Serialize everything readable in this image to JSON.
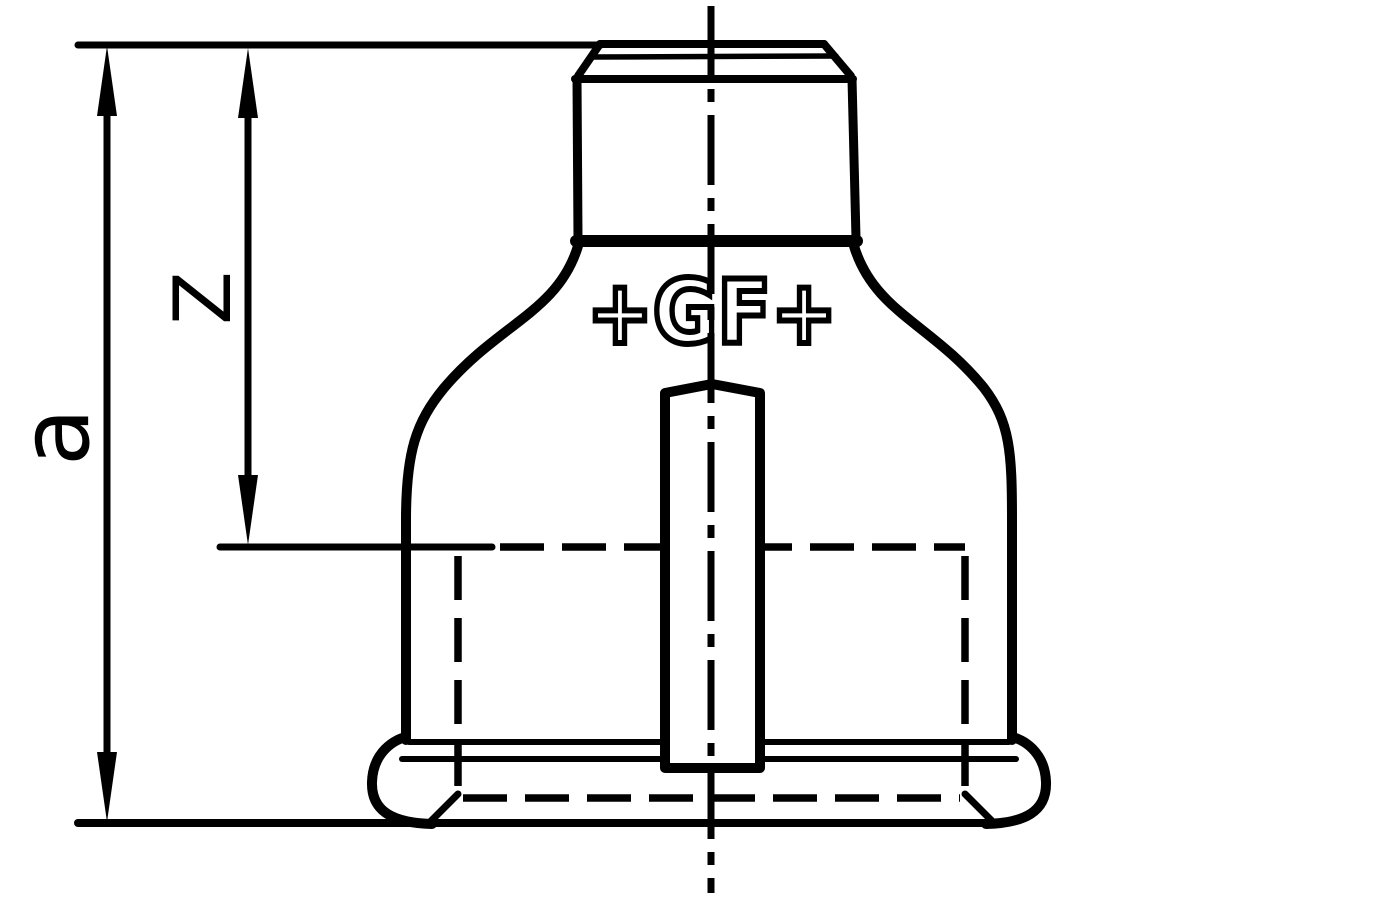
{
  "drawing": {
    "title": "pipe-fitting-dimension-drawing",
    "labels": {
      "dim_a": "a",
      "dim_z": "Z"
    },
    "logo_text": "+GF+",
    "colors": {
      "ink": "#000000",
      "background": "#ffffff"
    }
  }
}
